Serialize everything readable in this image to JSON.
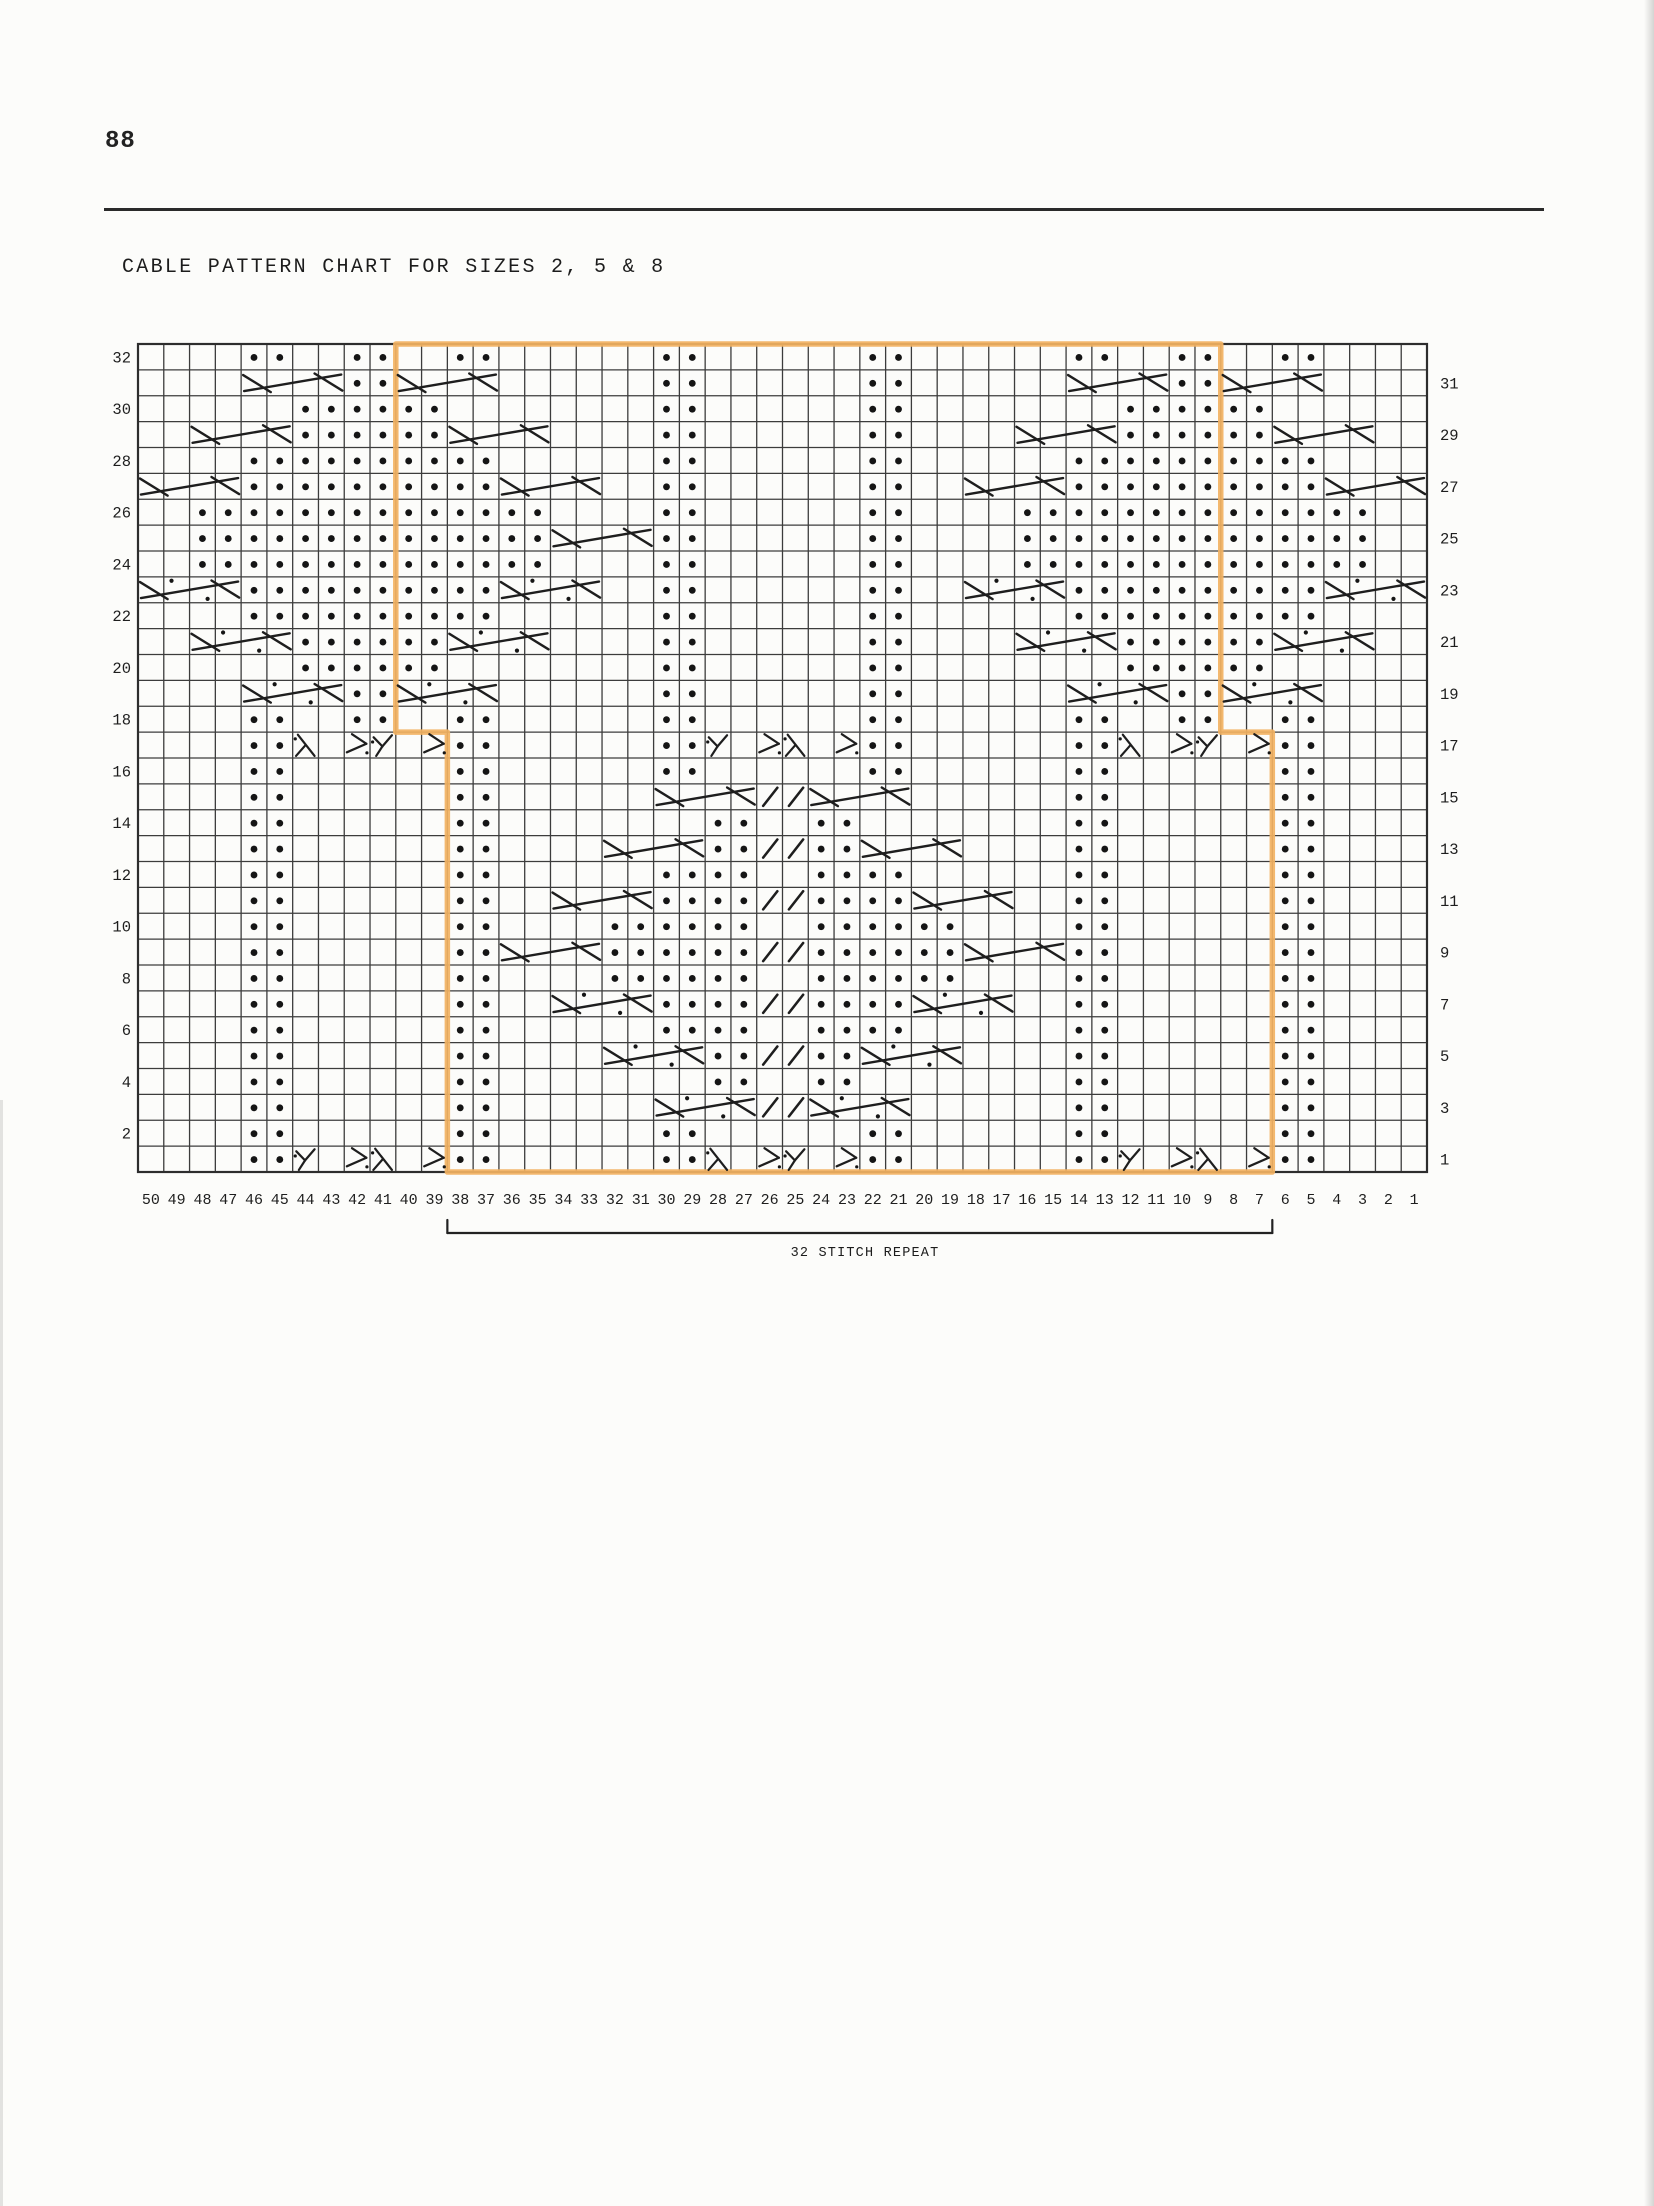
{
  "page": {
    "number": "88",
    "title": "CABLE PATTERN CHART FOR SIZES 2, 5 & 8"
  },
  "chart_data": {
    "type": "knitting-cable-chart",
    "title": "CABLE PATTERN CHART FOR SIZES 2, 5 & 8",
    "stitch_count": 50,
    "row_count": 32,
    "row_labels_left": [
      "32",
      "30",
      "28",
      "26",
      "24",
      "22",
      "20",
      "18",
      "16",
      "14",
      "12",
      "10",
      "8",
      "6",
      "4",
      "2"
    ],
    "row_labels_right": [
      "31",
      "29",
      "27",
      "25",
      "23",
      "21",
      "19",
      "17",
      "15",
      "13",
      "11",
      "9",
      "7",
      "5",
      "3",
      "1"
    ],
    "column_labels": [
      "50",
      "49",
      "48",
      "47",
      "46",
      "45",
      "44",
      "43",
      "42",
      "41",
      "40",
      "39",
      "38",
      "37",
      "36",
      "35",
      "34",
      "33",
      "32",
      "31",
      "30",
      "29",
      "28",
      "27",
      "26",
      "25",
      "24",
      "23",
      "22",
      "21",
      "20",
      "19",
      "18",
      "17",
      "16",
      "15",
      "14",
      "13",
      "12",
      "11",
      "10",
      "9",
      "8",
      "7",
      "6",
      "5",
      "4",
      "3",
      "2",
      "1"
    ],
    "symbol_key": {
      ".": "purl-dot",
      "/": "slash-twist-mark",
      "Y": "y-twist-symbol",
      "L": "lambda-twist-symbol",
      "K": "fork-twist-symbol",
      "cable": "four-stitch-cable-cross (dotted = purl cross)"
    },
    "grid": [
      {
        "row": 32,
        "cells": "    ..  ..  ..      ..      ..      ..  ..  ..    "
      },
      {
        "row": 31,
        "cells": "        ..          ..      ..          ..        "
      },
      {
        "row": 30,
        "cells": "      ......        ..      ..        ......      "
      },
      {
        "row": 29,
        "cells": "      ......        ..      ..        ......      "
      },
      {
        "row": 28,
        "cells": "    ..........      ..      ..      ..........    "
      },
      {
        "row": 27,
        "cells": "    ..........      ..      ..      ..........    "
      },
      {
        "row": 26,
        "cells": "  ..............    ..      ..    ..............  "
      },
      {
        "row": 25,
        "cells": "  ..............    ..      ..    ..............  "
      },
      {
        "row": 24,
        "cells": "  ..............    ..      ..    ..............  "
      },
      {
        "row": 23,
        "cells": "    ..........      ..      ..      ..........    "
      },
      {
        "row": 22,
        "cells": "    ..........      ..      ..      ..........    "
      },
      {
        "row": 21,
        "cells": "      ......        ..      ..        ......      "
      },
      {
        "row": 20,
        "cells": "      ......        ..      ..        ......      "
      },
      {
        "row": 19,
        "cells": "        ..          ..      ..          ..        "
      },
      {
        "row": 18,
        "cells": "    ..  ..  ..      ..      ..      ..  ..  ..    "
      },
      {
        "row": 17,
        "cells": "    ..L KY K..      ..Y KL K..      ..L KY K..    "
      },
      {
        "row": 16,
        "cells": "    ..      ..      ..      ..      ..      ..    "
      },
      {
        "row": 15,
        "cells": "    ..      ..          //          ..      ..    "
      },
      {
        "row": 14,
        "cells": "    ..      ..        ..  ..        ..      ..    "
      },
      {
        "row": 13,
        "cells": "    ..      ..        ..//..        ..      ..    "
      },
      {
        "row": 12,
        "cells": "    ..      ..      ....  ....      ..      ..    "
      },
      {
        "row": 11,
        "cells": "    ..      ..      ....//....      ..      ..    "
      },
      {
        "row": 10,
        "cells": "    ..      ..    ......  ......    ..      ..    "
      },
      {
        "row": 9,
        "cells": "    ..      ..    ......//......    ..      ..    "
      },
      {
        "row": 8,
        "cells": "    ..      ..    ......  ......    ..      ..    "
      },
      {
        "row": 7,
        "cells": "    ..      ..      ....//....      ..      ..    "
      },
      {
        "row": 6,
        "cells": "    ..      ..      ....  ....      ..      ..    "
      },
      {
        "row": 5,
        "cells": "    ..      ..        ..//..        ..      ..    "
      },
      {
        "row": 4,
        "cells": "    ..      ..        ..  ..        ..      ..    "
      },
      {
        "row": 3,
        "cells": "    ..      ..          //          ..      ..    "
      },
      {
        "row": 2,
        "cells": "    ..      ..      ..      ..      ..      ..    "
      },
      {
        "row": 1,
        "cells": "    ..Y KL K..      ..L KY K..      ..Y KL K..    "
      }
    ],
    "cables": [
      {
        "row": 31,
        "from": 46,
        "to": 43,
        "dotted": false
      },
      {
        "row": 31,
        "from": 40,
        "to": 37,
        "dotted": false
      },
      {
        "row": 31,
        "from": 14,
        "to": 11,
        "dotted": false
      },
      {
        "row": 31,
        "from": 8,
        "to": 5,
        "dotted": false
      },
      {
        "row": 29,
        "from": 48,
        "to": 45,
        "dotted": false
      },
      {
        "row": 29,
        "from": 38,
        "to": 35,
        "dotted": false
      },
      {
        "row": 29,
        "from": 16,
        "to": 13,
        "dotted": false
      },
      {
        "row": 29,
        "from": 6,
        "to": 3,
        "dotted": false
      },
      {
        "row": 27,
        "from": 50,
        "to": 47,
        "dotted": false
      },
      {
        "row": 27,
        "from": 36,
        "to": 33,
        "dotted": false
      },
      {
        "row": 27,
        "from": 18,
        "to": 15,
        "dotted": false
      },
      {
        "row": 27,
        "from": 4,
        "to": 1,
        "dotted": false
      },
      {
        "row": 25,
        "from": 34,
        "to": 31,
        "dotted": false
      },
      {
        "row": 23,
        "from": 50,
        "to": 47,
        "dotted": true
      },
      {
        "row": 23,
        "from": 36,
        "to": 33,
        "dotted": true
      },
      {
        "row": 23,
        "from": 18,
        "to": 15,
        "dotted": true
      },
      {
        "row": 23,
        "from": 4,
        "to": 1,
        "dotted": true
      },
      {
        "row": 21,
        "from": 48,
        "to": 45,
        "dotted": true
      },
      {
        "row": 21,
        "from": 38,
        "to": 35,
        "dotted": true
      },
      {
        "row": 21,
        "from": 16,
        "to": 13,
        "dotted": true
      },
      {
        "row": 21,
        "from": 6,
        "to": 3,
        "dotted": true
      },
      {
        "row": 19,
        "from": 46,
        "to": 43,
        "dotted": true
      },
      {
        "row": 19,
        "from": 40,
        "to": 37,
        "dotted": true
      },
      {
        "row": 19,
        "from": 14,
        "to": 11,
        "dotted": true
      },
      {
        "row": 19,
        "from": 8,
        "to": 5,
        "dotted": true
      },
      {
        "row": 15,
        "from": 30,
        "to": 27,
        "dotted": false
      },
      {
        "row": 15,
        "from": 24,
        "to": 21,
        "dotted": false
      },
      {
        "row": 13,
        "from": 32,
        "to": 29,
        "dotted": false
      },
      {
        "row": 13,
        "from": 22,
        "to": 19,
        "dotted": false
      },
      {
        "row": 11,
        "from": 34,
        "to": 31,
        "dotted": false
      },
      {
        "row": 11,
        "from": 20,
        "to": 17,
        "dotted": false
      },
      {
        "row": 9,
        "from": 36,
        "to": 33,
        "dotted": false
      },
      {
        "row": 9,
        "from": 18,
        "to": 15,
        "dotted": false
      },
      {
        "row": 7,
        "from": 34,
        "to": 31,
        "dotted": true
      },
      {
        "row": 7,
        "from": 20,
        "to": 17,
        "dotted": true
      },
      {
        "row": 5,
        "from": 32,
        "to": 29,
        "dotted": true
      },
      {
        "row": 5,
        "from": 22,
        "to": 19,
        "dotted": true
      },
      {
        "row": 3,
        "from": 30,
        "to": 27,
        "dotted": true
      },
      {
        "row": 3,
        "from": 24,
        "to": 21,
        "dotted": true
      }
    ],
    "repeat_outline": {
      "color": "#f2b262",
      "upper_left_col": 40,
      "upper_right_col": 9,
      "lower_left_col": 38,
      "lower_right_col": 7,
      "step_below_row": 18
    },
    "repeat_label": "32 STITCH REPEAT"
  }
}
